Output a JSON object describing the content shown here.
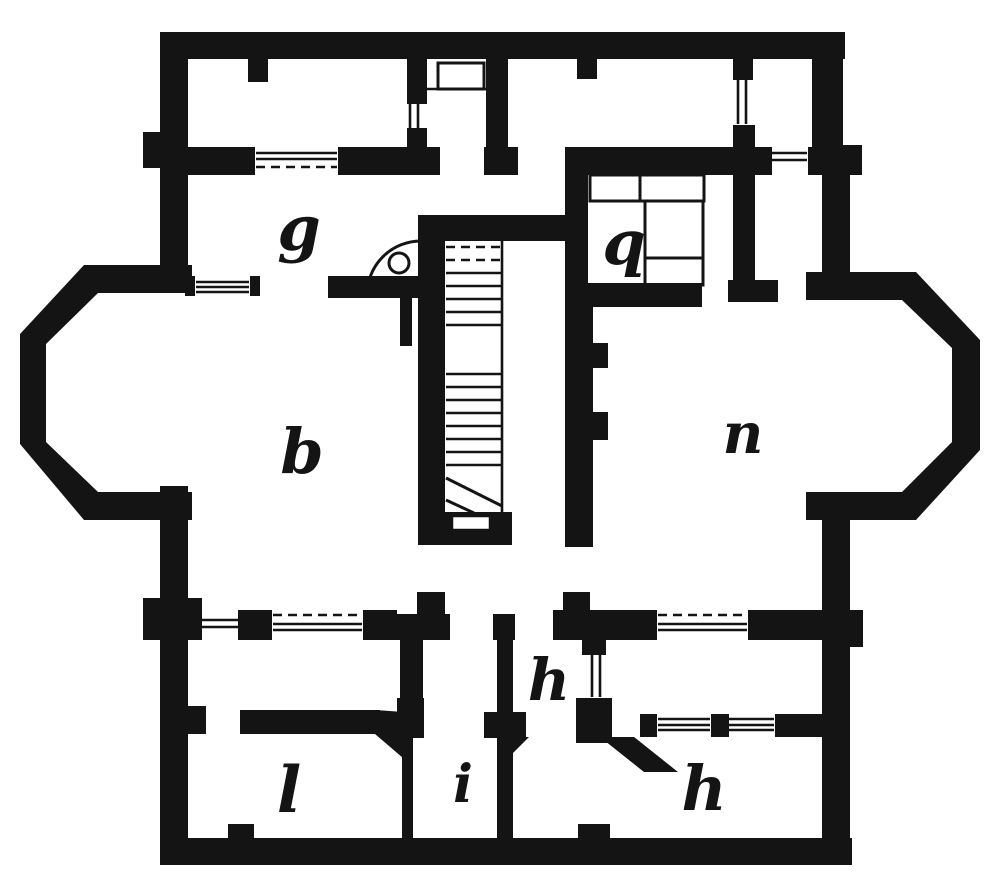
{
  "figure": {
    "kind": "scanned architectural floor plan engraving, one storey",
    "background_color": "#ffffff",
    "ink_color": "#141414",
    "rooms": [
      {
        "id": "g",
        "label": "g"
      },
      {
        "id": "q",
        "label": "q"
      },
      {
        "id": "b",
        "label": "b"
      },
      {
        "id": "n",
        "label": "n"
      },
      {
        "id": "h-upper",
        "label": "h"
      },
      {
        "id": "i",
        "label": "i"
      },
      {
        "id": "l",
        "label": "l"
      },
      {
        "id": "h-lower",
        "label": "h"
      }
    ]
  }
}
